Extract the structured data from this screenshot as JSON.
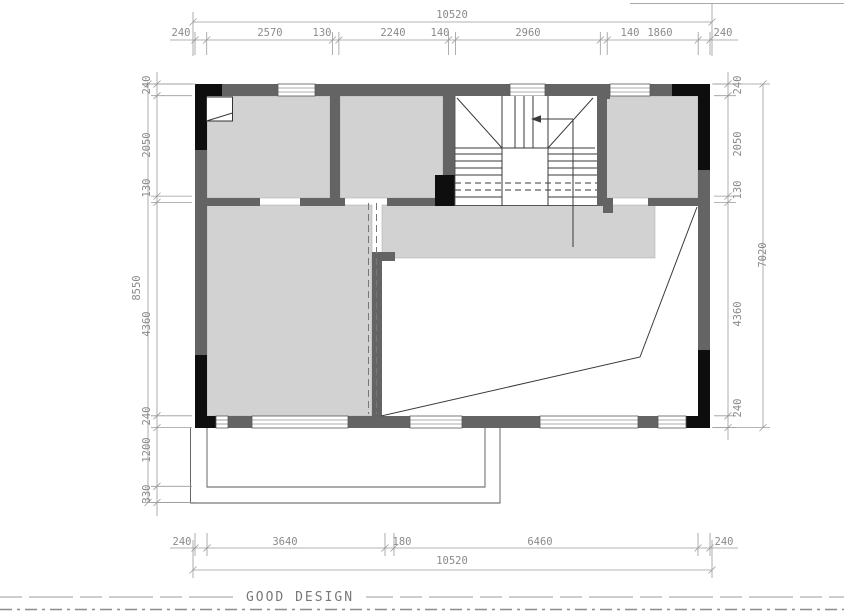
{
  "drawing": {
    "type": "floor-plan",
    "footer_brand": "GOOD DESIGN"
  },
  "dimensions": {
    "top": {
      "overall": "10520",
      "chain": [
        "240",
        "2570",
        "130",
        "2240",
        "140",
        "2960",
        "140",
        "1860",
        "240"
      ]
    },
    "bottom": {
      "overall": "10520",
      "chain": [
        "240",
        "3640",
        "180",
        "6460",
        "240"
      ]
    },
    "left": {
      "overall": "8550",
      "chain": [
        "240",
        "2050",
        "130",
        "4360",
        "240",
        "1200",
        "330"
      ]
    },
    "right": {
      "overall": "7020",
      "chain": [
        "240",
        "2050",
        "130",
        "4360",
        "240"
      ]
    }
  },
  "symbols": {
    "stair_direction": "up-arrow-left"
  },
  "colors": {
    "room_fill": "#d2d2d2",
    "wall": "#646464",
    "column": "#0e0e0e",
    "plan_line": "#3a3a3a",
    "dim_line": "#9a9a9a",
    "dim_text": "#8a8a8a",
    "background": "#ffffff"
  }
}
